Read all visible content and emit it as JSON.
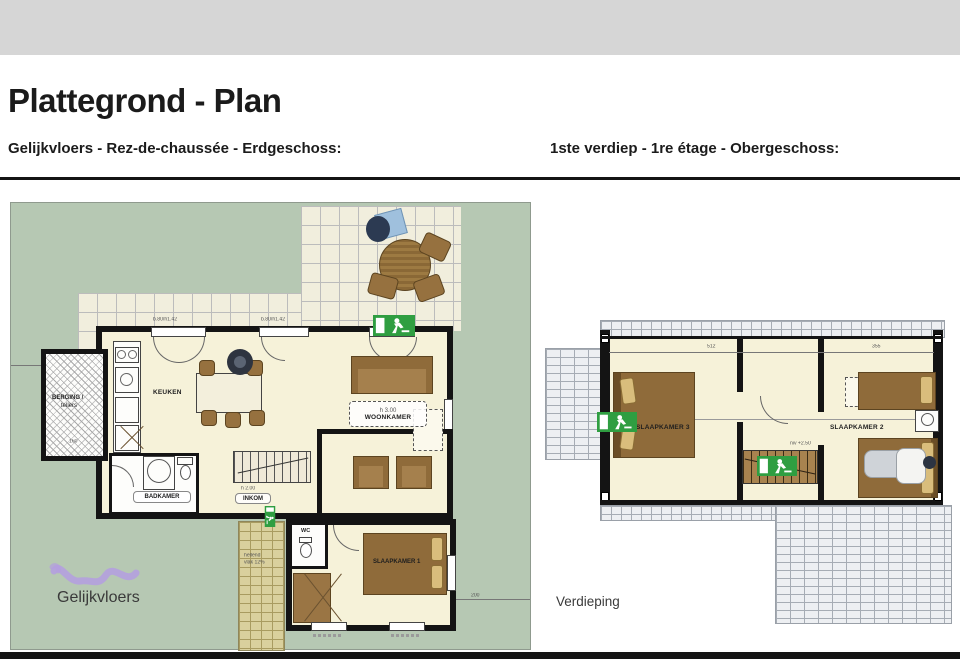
{
  "page": {
    "title": "Plattegrond - Plan",
    "subtitle_ground": "Gelijkvloers - Rez-de-chaussée - Erdgeschoss:",
    "subtitle_first": "1ste verdiep - 1re étage - Obergeschoss:"
  },
  "ground_floor": {
    "caption": "Gelijkvloers",
    "rooms": {
      "berging": {
        "line1": "BERGING /",
        "line2": "tellers"
      },
      "keuken": {
        "label": "KEUKEN"
      },
      "woonkamer": {
        "label": "WOONKAMER",
        "note": "h 3.00"
      },
      "badkamer": {
        "label": "BADKAMER"
      },
      "inkom": {
        "label": "INKOM",
        "note": "h 2.00"
      },
      "wc": {
        "label": "WC"
      },
      "slaapkamer1": {
        "label": "SLAAPKAMER 1"
      }
    },
    "dims": {
      "win_left": "b.80/h1.42",
      "win_right": "b.80/h1.42",
      "berging_width": "160",
      "path_note1": "hellend",
      "path_note2": "vlak 12%",
      "right_note": "200"
    }
  },
  "first_floor": {
    "caption": "Verdieping",
    "rooms": {
      "slaapkamer3": {
        "label": "SLAAPKAMER 3"
      },
      "slaapkamer2": {
        "label": "SLAAPKAMER 2"
      }
    },
    "notes": {
      "stairs_level": "niv +2.50"
    },
    "dims": {
      "left": "512",
      "right": "355"
    }
  },
  "colors": {
    "plan_background_green": "#b6c8b3",
    "floor_cream": "#f6f2d9",
    "wall_black": "#141414",
    "wood_brown": "#8f6b3a",
    "exit_sign_green": "#2f9e41",
    "walkway_beige": "#d9d09d",
    "scribble_purple": "#b49de0"
  }
}
